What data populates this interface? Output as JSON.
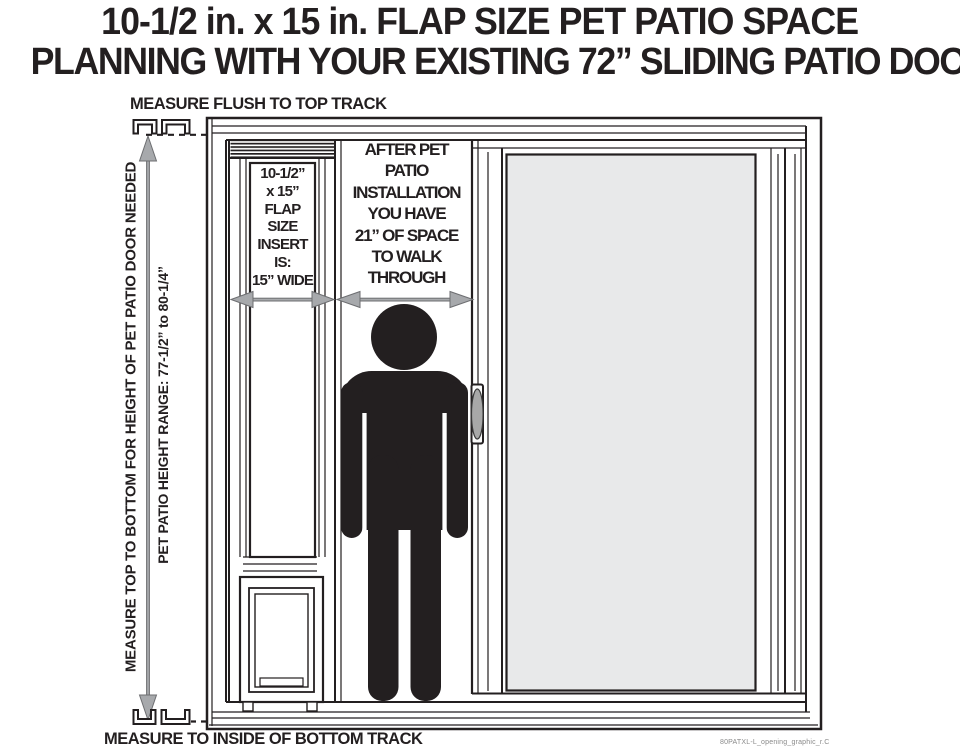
{
  "title": {
    "line1": "10-1/2 in. x 15 in. FLAP SIZE PET PATIO SPACE",
    "line2": "PLANNING WITH YOUR EXISTING 72” SLIDING PATIO DOOR"
  },
  "annotations": {
    "top_track_label": "MEASURE FLUSH TO TOP TRACK",
    "bottom_track_label": "MEASURE TO INSIDE OF BOTTOM TRACK",
    "height_measure_label": "MEASURE TOP TO BOTTOM FOR HEIGHT OF PET PATIO DOOR NEEDED",
    "height_range_label": "PET PATIO HEIGHT RANGE: 77-1/2” to 80-1/4”",
    "insert_label": {
      "lines": [
        "10-1/2”",
        "x 15”",
        "FLAP",
        "SIZE",
        "INSERT",
        "IS:",
        "15” WIDE"
      ]
    },
    "walkthrough_label": {
      "lines": [
        "AFTER PET",
        "PATIO",
        "INSTALLATION",
        "YOU HAVE",
        "21” OF SPACE",
        "TO WALK",
        "THROUGH"
      ]
    },
    "watermark": "80PATXL-L_opening_graphic_r.C"
  },
  "measurements": {
    "flap_size": "10-1/2 in. x 15 in.",
    "insert_width": "15 in.",
    "walkthrough_space": "21 in.",
    "door_width": "72 in.",
    "pet_patio_height_range": "77-1/2 in. to 80-1/4 in."
  },
  "colors": {
    "line": "#231f20",
    "arrow_fill": "#a7a9ac",
    "arrow_stroke": "#6d6e71",
    "glass": "#e8e9ea",
    "background": "#ffffff"
  }
}
